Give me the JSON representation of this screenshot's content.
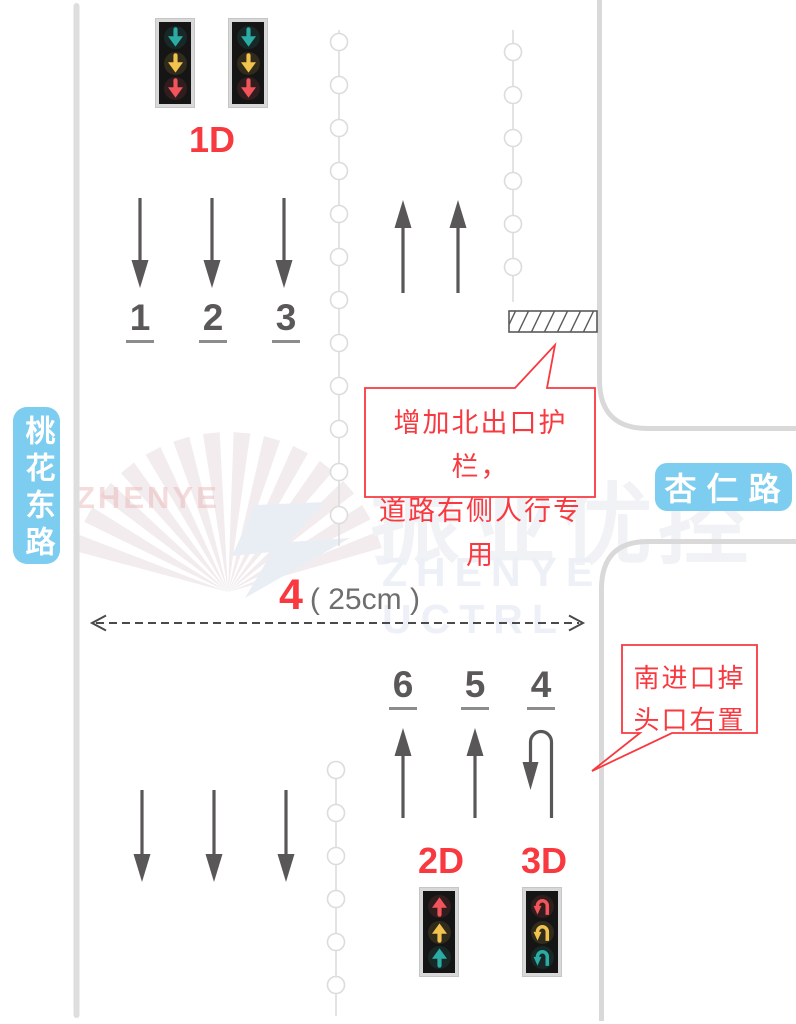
{
  "road_labels": {
    "west": "桃花东路",
    "east": "杏仁路"
  },
  "signal_groups": {
    "north": {
      "label": "1D",
      "icon": "down-arrow-icon",
      "heads": 2,
      "light_order": [
        "teal",
        "yellow",
        "red"
      ]
    },
    "south_straight": {
      "label": "2D",
      "icon": "up-arrow-icon",
      "heads": 1,
      "light_order": [
        "red",
        "yellow",
        "teal"
      ]
    },
    "south_uturn": {
      "label": "3D",
      "icon": "u-turn-arrow-icon",
      "heads": 1,
      "light_order": [
        "red",
        "yellow",
        "teal"
      ]
    }
  },
  "lanes": {
    "north_numbers": [
      "1",
      "2",
      "3"
    ],
    "south_numbers": [
      "6",
      "5",
      "4"
    ]
  },
  "dimension": {
    "number": "4",
    "size": "( 25cm )"
  },
  "callouts": {
    "north_exit_note": {
      "lines": [
        "增加北出口护栏，",
        "道路右侧人行专用"
      ]
    },
    "south_uturn_note": {
      "lines": [
        "南进口掉",
        "头口右置"
      ]
    }
  },
  "watermark": {
    "left_text": "ZHENYE",
    "cn": "振业优控",
    "en": "ZHENYE UCTRL"
  },
  "colors": {
    "accent_red": "#F8393F",
    "arrow_gray": "#595757",
    "road_edge_gray": "#DBDBDB",
    "road_label_blue": "#7CCDEF",
    "signal_teal": "#2AACA5",
    "signal_yellow": "#F1C24E",
    "signal_red": "#F1545A"
  }
}
